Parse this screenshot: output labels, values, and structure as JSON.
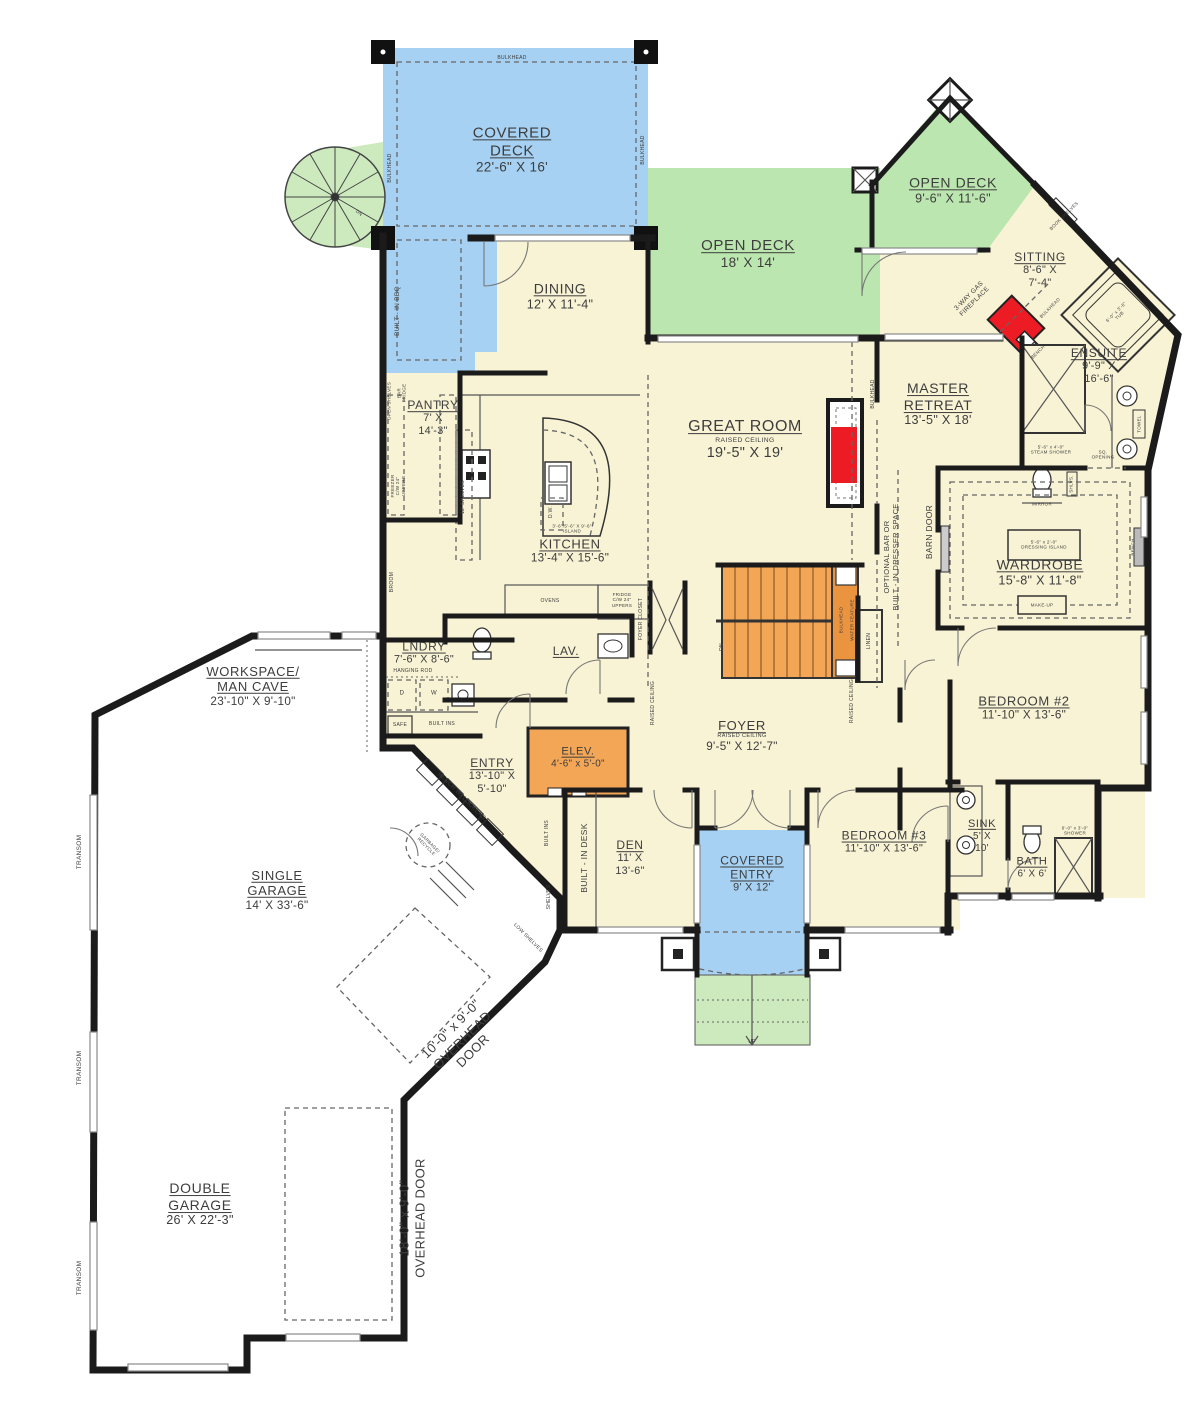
{
  "colors": {
    "cream": "#f8f3d4",
    "blue": "#a6d1f2",
    "green": "#bbe6af",
    "green-light": "#cdeabf",
    "orange": "#f3a656",
    "orange-dark": "#eb9440",
    "red": "#ed1c24",
    "wall": "#1b1b1b",
    "garage": "#ffffff"
  },
  "rooms": [
    {
      "id": "covered-deck",
      "lines": [
        "COVERED",
        "DECK"
      ],
      "dims": [
        "22'-6\" X 16'"
      ],
      "x": 512,
      "y": 150,
      "fs": 15
    },
    {
      "id": "open-deck-main",
      "lines": [
        "OPEN DECK"
      ],
      "dims": [
        "18' X 14'"
      ],
      "x": 748,
      "y": 254,
      "fs": 15
    },
    {
      "id": "open-deck-upper",
      "lines": [
        "OPEN DECK"
      ],
      "dims": [
        "9'-6\" X 11'-6\""
      ],
      "x": 953,
      "y": 190,
      "fs": 14
    },
    {
      "id": "sitting",
      "lines": [
        "SITTING"
      ],
      "dims": [
        "8'-6\" X",
        "7'-4\""
      ],
      "x": 1040,
      "y": 270,
      "fs": 12
    },
    {
      "id": "dining",
      "lines": [
        "DINING"
      ],
      "dims": [
        "12' X 11'-4\""
      ],
      "x": 560,
      "y": 296,
      "fs": 14
    },
    {
      "id": "great-room",
      "lines": [
        "GREAT ROOM"
      ],
      "sub": "RAISED CEILING",
      "dims": [
        "19'-5\" X 19'"
      ],
      "x": 745,
      "y": 440,
      "fs": 16
    },
    {
      "id": "master-retreat",
      "lines": [
        "MASTER",
        "RETREAT"
      ],
      "dims": [
        "13'-5\" X 18'"
      ],
      "x": 938,
      "y": 404,
      "fs": 14
    },
    {
      "id": "ensuite",
      "lines": [
        "ENSUITE"
      ],
      "dims": [
        "9'-9\" X",
        "16'-6\""
      ],
      "x": 1099,
      "y": 366,
      "fs": 12
    },
    {
      "id": "pantry",
      "lines": [
        "PANTRY"
      ],
      "dims": [
        "7' X",
        "14'-3\""
      ],
      "x": 433,
      "y": 418,
      "fs": 12
    },
    {
      "id": "kitchen",
      "lines": [
        "KITCHEN"
      ],
      "dims": [
        "13'-4\" X 15'-6\""
      ],
      "x": 570,
      "y": 551,
      "fs": 13
    },
    {
      "id": "wardrobe",
      "lines": [
        "WARDROBE"
      ],
      "dims": [
        "15'-8\" X 11'-8\""
      ],
      "x": 1040,
      "y": 572,
      "fs": 14
    },
    {
      "id": "lndry",
      "lines": [
        "LNDRY"
      ],
      "dims": [
        "7'-6\" X 8'-6\""
      ],
      "x": 424,
      "y": 653,
      "fs": 12
    },
    {
      "id": "lav",
      "lines": [
        "LAV."
      ],
      "dims": [],
      "x": 566,
      "y": 651,
      "fs": 12
    },
    {
      "id": "workspace",
      "lines": [
        "WORKSPACE/",
        "MAN CAVE"
      ],
      "dims": [
        "23'-10\" X 9'-10\""
      ],
      "x": 253,
      "y": 686,
      "fs": 13
    },
    {
      "id": "bedroom-2",
      "lines": [
        "BEDROOM #2"
      ],
      "dims": [
        "11'-10\" X 13'-6\""
      ],
      "x": 1024,
      "y": 708,
      "fs": 13
    },
    {
      "id": "entry",
      "lines": [
        "ENTRY"
      ],
      "dims": [
        "13'-10\" X",
        "5'-10\""
      ],
      "x": 492,
      "y": 776,
      "fs": 12
    },
    {
      "id": "elev",
      "lines": [
        "ELEV."
      ],
      "dims": [
        "4'-6\" x 5'-0\""
      ],
      "x": 578,
      "y": 758,
      "fs": 11
    },
    {
      "id": "foyer",
      "lines": [
        "FOYER"
      ],
      "sub": "RAISED CEILING",
      "dims": [
        "9'-5\" X 12'-7\""
      ],
      "x": 742,
      "y": 736,
      "fs": 13
    },
    {
      "id": "den",
      "lines": [
        "DEN"
      ],
      "dims": [
        "11' X",
        "13'-6\""
      ],
      "x": 630,
      "y": 858,
      "fs": 12
    },
    {
      "id": "bedroom-3",
      "lines": [
        "BEDROOM #3"
      ],
      "dims": [
        "11'-10\" X 13'-6\""
      ],
      "x": 884,
      "y": 842,
      "fs": 12
    },
    {
      "id": "sink",
      "lines": [
        "SINK"
      ],
      "dims": [
        "5' X",
        "10'"
      ],
      "x": 982,
      "y": 836,
      "fs": 11
    },
    {
      "id": "bath",
      "lines": [
        "BATH"
      ],
      "dims": [
        "6' X 6'"
      ],
      "x": 1032,
      "y": 868,
      "fs": 11
    },
    {
      "id": "covered-entry",
      "lines": [
        "COVERED",
        "ENTRY"
      ],
      "dims": [
        "9' X 12'"
      ],
      "x": 752,
      "y": 874,
      "fs": 12
    },
    {
      "id": "single-garage",
      "lines": [
        "SINGLE",
        "GARAGE"
      ],
      "dims": [
        "14' X 33'-6\""
      ],
      "x": 277,
      "y": 890,
      "fs": 13
    },
    {
      "id": "double-garage",
      "lines": [
        "DOUBLE",
        "GARAGE"
      ],
      "dims": [
        "26' X 22'-3\""
      ],
      "x": 200,
      "y": 1204,
      "fs": 14
    }
  ],
  "annotations": [
    {
      "id": "bulkhead-deck-top",
      "lines": [
        "BULKHEAD"
      ],
      "x": 512,
      "y": 58,
      "r": 0,
      "s": 5
    },
    {
      "id": "bulkhead-deck-left",
      "lines": [
        "BULKHEAD"
      ],
      "x": 390,
      "y": 168,
      "r": -90,
      "s": 5
    },
    {
      "id": "bulkhead-deck-right",
      "lines": [
        "BULKHEAD"
      ],
      "x": 643,
      "y": 150,
      "r": -90,
      "s": 5
    },
    {
      "id": "built-in-bbq",
      "lines": [
        "BUILT - IN BBQ"
      ],
      "x": 398,
      "y": 311,
      "r": -90,
      "s": 6.5
    },
    {
      "id": "open-shelves",
      "lines": [
        "OPEN SHELVES"
      ],
      "x": 389,
      "y": 401,
      "r": -90,
      "s": 4.5
    },
    {
      "id": "bar-fridge",
      "lines": [
        "BAR",
        "FRIDGE"
      ],
      "x": 402,
      "y": 393,
      "r": -90,
      "s": 4.5
    },
    {
      "id": "freezer-uppers",
      "lines": [
        "FREEZER",
        "C/W 24\"",
        "UPPERS"
      ],
      "x": 398,
      "y": 486,
      "r": -90,
      "s": 4.5
    },
    {
      "id": "shelves-12",
      "lines": [
        "12' SHELVES"
      ],
      "x": 463,
      "y": 497,
      "r": -90,
      "s": 5
    },
    {
      "id": "broom",
      "lines": [
        "BROOM"
      ],
      "x": 392,
      "y": 582,
      "r": -90,
      "s": 5
    },
    {
      "id": "hanging-rod",
      "lines": [
        "HANGING ROD"
      ],
      "x": 413,
      "y": 671,
      "r": 0,
      "s": 5
    },
    {
      "id": "safe",
      "lines": [
        "SAFE"
      ],
      "x": 400,
      "y": 725,
      "r": 0,
      "s": 5
    },
    {
      "id": "built-ins-lndry",
      "lines": [
        "BUILT INS"
      ],
      "x": 442,
      "y": 724,
      "r": 0,
      "s": 5
    },
    {
      "id": "dryer",
      "lines": [
        "D"
      ],
      "x": 402,
      "y": 694,
      "r": 0,
      "s": 6
    },
    {
      "id": "washer",
      "lines": [
        "W"
      ],
      "x": 434,
      "y": 694,
      "r": 0,
      "s": 6
    },
    {
      "id": "bench-lockers",
      "lines": [
        "BENCH W/ LOCKERS"
      ],
      "x": 461,
      "y": 797,
      "r": 45,
      "s": 6
    },
    {
      "id": "garbage-recycle",
      "lines": [
        "GARBAGE/",
        "RECYCLE"
      ],
      "x": 428,
      "y": 845,
      "r": 45,
      "s": 4.5
    },
    {
      "id": "built-ins-entry",
      "lines": [
        "BUILT INS"
      ],
      "x": 547,
      "y": 833,
      "r": -90,
      "s": 5
    },
    {
      "id": "built-in-desk",
      "lines": [
        "BUILT - IN DESK"
      ],
      "x": 584,
      "y": 858,
      "r": -90,
      "s": 8.5
    },
    {
      "id": "shelves-den",
      "lines": [
        "SHELVES"
      ],
      "x": 549,
      "y": 897,
      "r": -90,
      "s": 5
    },
    {
      "id": "low-shelves",
      "lines": [
        "LOW SHELVES"
      ],
      "x": 528,
      "y": 938,
      "r": 45,
      "s": 5
    },
    {
      "id": "dw",
      "lines": [
        "D.W."
      ],
      "x": 551,
      "y": 512,
      "r": -90,
      "s": 5
    },
    {
      "id": "island",
      "lines": [
        "3'-6\"/5'-6\" X 9'-6\"",
        "ISLAND"
      ],
      "x": 572,
      "y": 529,
      "r": 0,
      "s": 4.5
    },
    {
      "id": "ovens",
      "lines": [
        "OVENS"
      ],
      "x": 550,
      "y": 601,
      "r": 0,
      "s": 5
    },
    {
      "id": "fridge-uppers",
      "lines": [
        "FRIDGE",
        "C/W 24\"",
        "UPPERS"
      ],
      "x": 622,
      "y": 600,
      "r": 0,
      "s": 4.5
    },
    {
      "id": "foyer-closet",
      "lines": [
        "FOYER CLOSET"
      ],
      "x": 641,
      "y": 619,
      "r": -90,
      "s": 5
    },
    {
      "id": "raised-ceiling-1",
      "lines": [
        "RAISED CEILING"
      ],
      "x": 653,
      "y": 703,
      "r": -90,
      "s": 5
    },
    {
      "id": "raised-ceiling-2",
      "lines": [
        "RAISED CEILING"
      ],
      "x": 852,
      "y": 701,
      "r": -90,
      "s": 5
    },
    {
      "id": "stairs-dn",
      "lines": [
        "DN"
      ],
      "x": 722,
      "y": 647,
      "r": -90,
      "s": 5
    },
    {
      "id": "bulkhead-stairs",
      "lines": [
        "BULKHEAD"
      ],
      "x": 841,
      "y": 620,
      "r": -90,
      "s": 4.5
    },
    {
      "id": "water-feature",
      "lines": [
        "WATER FEATURE"
      ],
      "x": 852,
      "y": 620,
      "r": -90,
      "s": 4.5
    },
    {
      "id": "linen",
      "lines": [
        "LINEN"
      ],
      "x": 869,
      "y": 641,
      "r": -90,
      "s": 5
    },
    {
      "id": "bulkhead-master",
      "lines": [
        "BULKHEAD"
      ],
      "x": 873,
      "y": 394,
      "r": -90,
      "s": 5
    },
    {
      "id": "optional-bar",
      "lines": [
        "OPTIONAL BAR OR",
        "BUILT - IN DRESSER SPACE"
      ],
      "x": 891,
      "y": 557,
      "r": -90,
      "s": 7.5
    },
    {
      "id": "barn-door",
      "lines": [
        "BARN DOOR"
      ],
      "x": 929,
      "y": 532,
      "r": -90,
      "s": 8.5
    },
    {
      "id": "gas-fireplace",
      "lines": [
        "3-WAY GAS",
        "FIREPLACE"
      ],
      "x": 972,
      "y": 299,
      "r": -45,
      "s": 6.5
    },
    {
      "id": "bulkhead-sitting",
      "lines": [
        "BULKHEAD"
      ],
      "x": 1050,
      "y": 308,
      "r": -45,
      "s": 4.5
    },
    {
      "id": "bench-fireplace",
      "lines": [
        "BENCH"
      ],
      "x": 1038,
      "y": 352,
      "r": -45,
      "s": 4.5
    },
    {
      "id": "book-shelves",
      "lines": [
        "BOOK SHELVES"
      ],
      "x": 1064,
      "y": 216,
      "r": -45,
      "s": 4.5
    },
    {
      "id": "tub",
      "lines": [
        "6'-0\" x 3'-6\"",
        "TUB"
      ],
      "x": 1118,
      "y": 314,
      "r": -45,
      "s": 4.5
    },
    {
      "id": "steam-shower",
      "lines": [
        "5'-6\" x 4'-0\"",
        "STEAM SHOWER"
      ],
      "x": 1051,
      "y": 450,
      "r": 0,
      "s": 4.5
    },
    {
      "id": "towel",
      "lines": [
        "TOWEL"
      ],
      "x": 1139,
      "y": 424,
      "r": -90,
      "s": 4.5
    },
    {
      "id": "sq-opening",
      "lines": [
        "SQ.",
        "OPENING"
      ],
      "x": 1103,
      "y": 455,
      "r": 0,
      "s": 4.5
    },
    {
      "id": "shlvs",
      "lines": [
        "SHLVS."
      ],
      "x": 1071,
      "y": 484,
      "r": -90,
      "s": 4.5
    },
    {
      "id": "mirror",
      "lines": [
        "MIRROR"
      ],
      "x": 1042,
      "y": 504,
      "r": 0,
      "s": 4.5
    },
    {
      "id": "dressing-island",
      "lines": [
        "5'-6\" x 2'-0\"",
        "DRESSING ISLAND"
      ],
      "x": 1044,
      "y": 545,
      "r": 0,
      "s": 4.5
    },
    {
      "id": "make-up",
      "lines": [
        "MAKE-UP"
      ],
      "x": 1042,
      "y": 605,
      "r": 0,
      "s": 4.5
    },
    {
      "id": "bench-wardrobe",
      "lines": [
        "BENCH"
      ],
      "x": 1133,
      "y": 547,
      "r": -90,
      "s": 4.5
    },
    {
      "id": "shower-bath",
      "lines": [
        "6'-0\" x 3'-0\"",
        "SHOWER"
      ],
      "x": 1075,
      "y": 831,
      "r": 0,
      "s": 4.5
    },
    {
      "id": "up-steps",
      "lines": [
        "UP"
      ],
      "x": 752,
      "y": 1042,
      "r": 0,
      "s": 5
    },
    {
      "id": "dn-spiral",
      "lines": [
        "DN"
      ],
      "x": 359,
      "y": 213,
      "r": 40,
      "s": 4.5
    },
    {
      "id": "transom-1",
      "lines": [
        "TRANSOM"
      ],
      "x": 80,
      "y": 852,
      "r": -90,
      "s": 6.5
    },
    {
      "id": "transom-2",
      "lines": [
        "TRANSOM"
      ],
      "x": 80,
      "y": 1068,
      "r": -90,
      "s": 6.5
    },
    {
      "id": "transom-3",
      "lines": [
        "TRANSOM"
      ],
      "x": 80,
      "y": 1278,
      "r": -90,
      "s": 6.5
    },
    {
      "id": "overhead-door-single",
      "lines": [
        "10'-0\" x 9'-0\"",
        "OVERHEAD",
        "DOOR"
      ],
      "x": 462,
      "y": 1040,
      "r": -45,
      "s": 13
    },
    {
      "id": "overhead-door-double",
      "lines": [
        "18'-0\" x 9'-0\"",
        "OVERHEAD DOOR"
      ],
      "x": 412,
      "y": 1218,
      "r": -90,
      "s": 13
    }
  ]
}
